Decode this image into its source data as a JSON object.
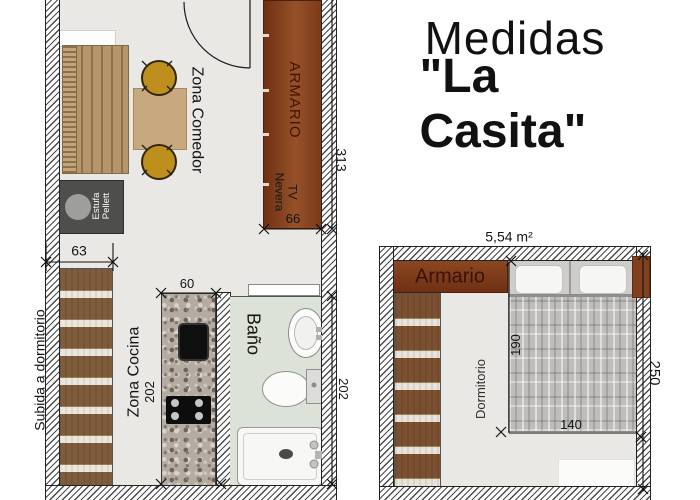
{
  "title": {
    "line1": "Medidas",
    "line2": "\"La Casita\""
  },
  "living_plan": {
    "labels": {
      "zona_comedor": "Zona Comedor",
      "armario": "ARMARIO",
      "tv": "TV",
      "nevera": "Nevera",
      "estufa_line1": "Estufa",
      "estufa_line2": "Pellett",
      "subida_dormitorio": "Subida a dormitorio",
      "zona_cocina": "Zona Cocina",
      "bano": "Baño"
    },
    "dimensions": {
      "armario_depth": "66",
      "room_length": "313",
      "stairs_width": "63",
      "counter_width": "60",
      "kitchen_length": "202",
      "bano_length": "202"
    }
  },
  "bedroom_plan": {
    "area_label": "5,54 m²",
    "labels": {
      "armario": "Armario",
      "dormitorio": "Dormitorio"
    },
    "dimensions": {
      "bed_length": "190",
      "bed_width": "140",
      "room_width": "250"
    }
  },
  "colors": {
    "wood_brown": "#8c4721",
    "floor_gray": "#e9e8e5",
    "bath_floor_green": "#dce2d8",
    "chair_gold": "#bf8f1e"
  }
}
